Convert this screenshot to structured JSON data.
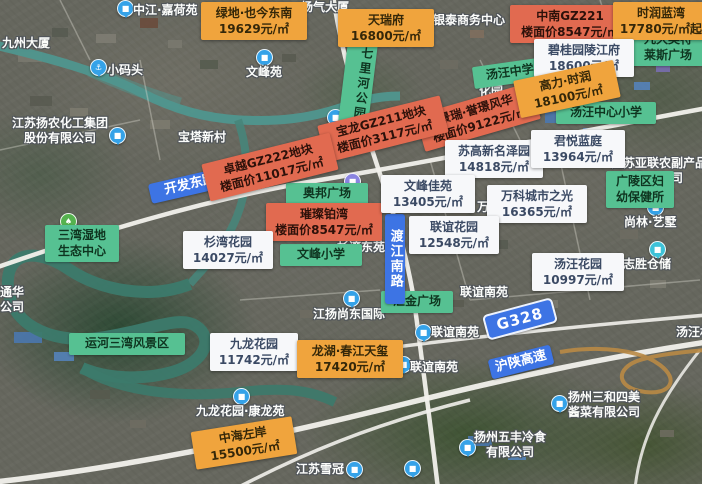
{
  "map_type": "satellite-with-housing-prices",
  "colors": {
    "price_orange": "#f0a43d",
    "price_red": "#e16a50",
    "price_white": "#f7f8fa",
    "area_green": "#56c192",
    "road_blue": "#3d74e4",
    "poi_blue": "#35a2e8",
    "poi_teal": "#3dc2d8",
    "poi_green": "#55b24e",
    "poi_purple": "#8a84e0"
  },
  "icon_glyphs": {
    "building": "■",
    "anchor": "⚓",
    "park": "♠"
  },
  "price_labels": [
    {
      "name": "绿地·也今东南",
      "price": "19629元/㎡",
      "style": "orange",
      "x": 201,
      "y": 2,
      "w": 98,
      "rot": 0
    },
    {
      "name": "天瑞府",
      "price": "16800元/㎡",
      "style": "orange",
      "x": 338,
      "y": 9,
      "w": 88,
      "rot": 0
    },
    {
      "name": "中南GZ221",
      "price": "楼面价8547元/㎡",
      "style": "red",
      "x": 510,
      "y": 5,
      "w": 112,
      "rot": 0
    },
    {
      "name": "时润蓝湾",
      "price": "17780元/㎡起",
      "style": "orange",
      "x": 613,
      "y": 2,
      "w": 88,
      "rot": 0
    },
    {
      "name": "碧桂园陵江府",
      "price": "18600元/㎡",
      "style": "white",
      "x": 534,
      "y": 39,
      "w": 92,
      "rot": 0
    },
    {
      "name": "景瑞·誉璟风华",
      "price": "楼面价9122元/㎡",
      "style": "red",
      "x": 418,
      "y": 98,
      "w": 112,
      "rot": -16
    },
    {
      "name": "高力·时润",
      "price": "18100元/㎡",
      "style": "orange",
      "x": 516,
      "y": 70,
      "w": 94,
      "rot": -12
    },
    {
      "name": "宝龙GZ211地块",
      "price": "楼面价3117元/㎡",
      "style": "red",
      "x": 320,
      "y": 110,
      "w": 118,
      "rot": -14
    },
    {
      "name": "卓越GZ222地块",
      "price": "楼面价11017元/㎡",
      "style": "red",
      "x": 204,
      "y": 148,
      "w": 124,
      "rot": -14
    },
    {
      "name": "苏高新名泽园",
      "price": "14818元/㎡",
      "style": "white",
      "x": 445,
      "y": 140,
      "w": 90,
      "rot": 0
    },
    {
      "name": "君悦蓝庭",
      "price": "13964元/㎡",
      "style": "white",
      "x": 531,
      "y": 130,
      "w": 86,
      "rot": 0
    },
    {
      "name": "璀璨铂湾",
      "price": "楼面价8547元/㎡",
      "style": "red",
      "x": 266,
      "y": 203,
      "w": 108,
      "rot": 0
    },
    {
      "name": "文峰佳苑",
      "price": "13405元/㎡",
      "style": "white",
      "x": 381,
      "y": 175,
      "w": 86,
      "rot": 0
    },
    {
      "name": "万科城市之光",
      "price": "16365元/㎡",
      "style": "white",
      "x": 487,
      "y": 185,
      "w": 92,
      "rot": 0
    },
    {
      "name": "杉湾花园",
      "price": "14027元/㎡",
      "style": "white",
      "x": 183,
      "y": 231,
      "w": 82,
      "rot": 0
    },
    {
      "name": "联谊花园",
      "price": "12548元/㎡",
      "style": "white",
      "x": 409,
      "y": 216,
      "w": 82,
      "rot": 0
    },
    {
      "name": "汤汪花园",
      "price": "10997元/㎡",
      "style": "white",
      "x": 532,
      "y": 253,
      "w": 84,
      "rot": 0
    },
    {
      "name": "九龙花园",
      "price": "11742元/㎡",
      "style": "white",
      "x": 210,
      "y": 333,
      "w": 80,
      "rot": 0
    },
    {
      "name": "龙湖·春江天玺",
      "price": "17420元/㎡",
      "style": "orange",
      "x": 297,
      "y": 340,
      "w": 98,
      "rot": 0
    },
    {
      "name": "中海左岸",
      "price": "15500元/㎡",
      "style": "orange",
      "x": 193,
      "y": 424,
      "w": 94,
      "rot": -9
    }
  ],
  "area_labels": [
    {
      "lines": [
        "七里河公园"
      ],
      "x": 343,
      "y": 30,
      "w": 24,
      "h": 94,
      "rot": 7,
      "vertical": true
    },
    {
      "lines": [
        "汤汪中学"
      ],
      "x": 473,
      "y": 62,
      "w": 64,
      "rot": -8
    },
    {
      "lines": [
        "九久奥特",
        "莱斯广场"
      ],
      "x": 629,
      "y": 29,
      "w": 68,
      "rot": 0
    },
    {
      "lines": [
        "汤汪中心小学"
      ],
      "x": 556,
      "y": 102,
      "w": 90,
      "rot": 0
    },
    {
      "lines": [
        "广陵区妇",
        "幼保健所"
      ],
      "x": 606,
      "y": 171,
      "w": 58,
      "rot": 0
    },
    {
      "lines": [
        "奥邦广场"
      ],
      "x": 286,
      "y": 183,
      "w": 72,
      "rot": 0
    },
    {
      "lines": [
        "三湾湿地",
        "生态中心"
      ],
      "x": 45,
      "y": 225,
      "w": 64,
      "rot": 0
    },
    {
      "lines": [
        "文峰小学"
      ],
      "x": 280,
      "y": 244,
      "w": 72,
      "rot": 0
    },
    {
      "lines": [
        "汇金广场"
      ],
      "x": 381,
      "y": 291,
      "w": 62,
      "rot": 0
    },
    {
      "lines": [
        "运河三湾风景区"
      ],
      "x": 69,
      "y": 333,
      "w": 106,
      "rot": 0
    }
  ],
  "road_labels": [
    {
      "text": "开发东路",
      "x": 149,
      "y": 175,
      "w": 70,
      "rot": -13,
      "vertical": false,
      "badge": false
    },
    {
      "text": "渡江南路",
      "x": 385,
      "y": 214,
      "h": 78,
      "rot": 0,
      "vertical": true,
      "badge": false
    },
    {
      "text": "G328",
      "x": 484,
      "y": 306,
      "rot": -15,
      "vertical": false,
      "badge": true
    },
    {
      "text": "沪陕高速",
      "x": 489,
      "y": 352,
      "rot": -14,
      "vertical": false,
      "badge": false
    }
  ],
  "poi_texts": [
    {
      "lines": [
        "中江·嘉荷苑"
      ],
      "x": 133,
      "y": 3
    },
    {
      "lines": [
        "九州大厦"
      ],
      "x": 2,
      "y": 36
    },
    {
      "lines": [
        "扬气大厦"
      ],
      "x": 301,
      "y": 0
    },
    {
      "lines": [
        "银泰商务中心"
      ],
      "x": 433,
      "y": 13
    },
    {
      "lines": [
        "小码头"
      ],
      "x": 107,
      "y": 63
    },
    {
      "lines": [
        "文峰苑"
      ],
      "x": 246,
      "y": 65
    },
    {
      "lines": [
        "江苏扬农化工集团",
        "股份有限公司"
      ],
      "x": 12,
      "y": 116
    },
    {
      "lines": [
        "宝塔新村"
      ],
      "x": 178,
      "y": 130
    },
    {
      "lines": [
        "化园"
      ],
      "x": 479,
      "y": 84
    },
    {
      "lines": [
        "江苏亚联农副产品",
        "有限公司"
      ],
      "x": 611,
      "y": 156
    },
    {
      "lines": [
        "杉湾东苑"
      ],
      "x": 337,
      "y": 240
    },
    {
      "lines": [
        "万"
      ],
      "x": 477,
      "y": 200
    },
    {
      "lines": [
        "尚林·艺墅"
      ],
      "x": 624,
      "y": 215
    },
    {
      "lines": [
        "志胜仓储"
      ],
      "x": 623,
      "y": 257
    },
    {
      "lines": [
        "联谊南苑"
      ],
      "x": 460,
      "y": 285
    },
    {
      "lines": [
        "联谊南苑"
      ],
      "x": 431,
      "y": 325
    },
    {
      "lines": [
        "汤汪村"
      ],
      "x": 676,
      "y": 325
    },
    {
      "lines": [
        "江扬尚东国际"
      ],
      "x": 313,
      "y": 307
    },
    {
      "lines": [
        "联谊南苑"
      ],
      "x": 410,
      "y": 360
    },
    {
      "lines": [
        "九龙花园·康龙苑"
      ],
      "x": 196,
      "y": 404
    },
    {
      "lines": [
        "通华",
        "公司"
      ],
      "x": 0,
      "y": 285
    },
    {
      "lines": [
        "江苏雪冠"
      ],
      "x": 296,
      "y": 462
    },
    {
      "lines": [
        "扬州三和四美",
        "酱菜有限公司"
      ],
      "x": 568,
      "y": 390
    },
    {
      "lines": [
        "扬州五丰冷食",
        "有限公司"
      ],
      "x": 474,
      "y": 430
    }
  ],
  "poi_icons": [
    {
      "type": "building",
      "color": "blue",
      "x": 117,
      "y": 0
    },
    {
      "type": "building",
      "color": "blue",
      "x": 417,
      "y": 12
    },
    {
      "type": "anchor",
      "color": "blue",
      "x": 90,
      "y": 59
    },
    {
      "type": "building",
      "color": "blue",
      "x": 256,
      "y": 49
    },
    {
      "type": "building",
      "color": "blue",
      "x": 109,
      "y": 127
    },
    {
      "type": "building",
      "color": "blue",
      "x": 327,
      "y": 109
    },
    {
      "type": "building",
      "color": "purple",
      "x": 344,
      "y": 173
    },
    {
      "type": "building",
      "color": "blue",
      "x": 647,
      "y": 199
    },
    {
      "type": "building",
      "color": "teal",
      "x": 649,
      "y": 241
    },
    {
      "type": "park",
      "color": "green",
      "x": 60,
      "y": 213
    },
    {
      "type": "building",
      "color": "blue",
      "x": 343,
      "y": 290
    },
    {
      "type": "building",
      "color": "blue",
      "x": 415,
      "y": 324
    },
    {
      "type": "building",
      "color": "blue",
      "x": 395,
      "y": 356
    },
    {
      "type": "building",
      "color": "blue",
      "x": 233,
      "y": 388
    },
    {
      "type": "building",
      "color": "blue",
      "x": 346,
      "y": 461
    },
    {
      "type": "building",
      "color": "blue",
      "x": 404,
      "y": 460
    },
    {
      "type": "building",
      "color": "blue",
      "x": 551,
      "y": 395
    },
    {
      "type": "building",
      "color": "blue",
      "x": 459,
      "y": 439
    }
  ]
}
